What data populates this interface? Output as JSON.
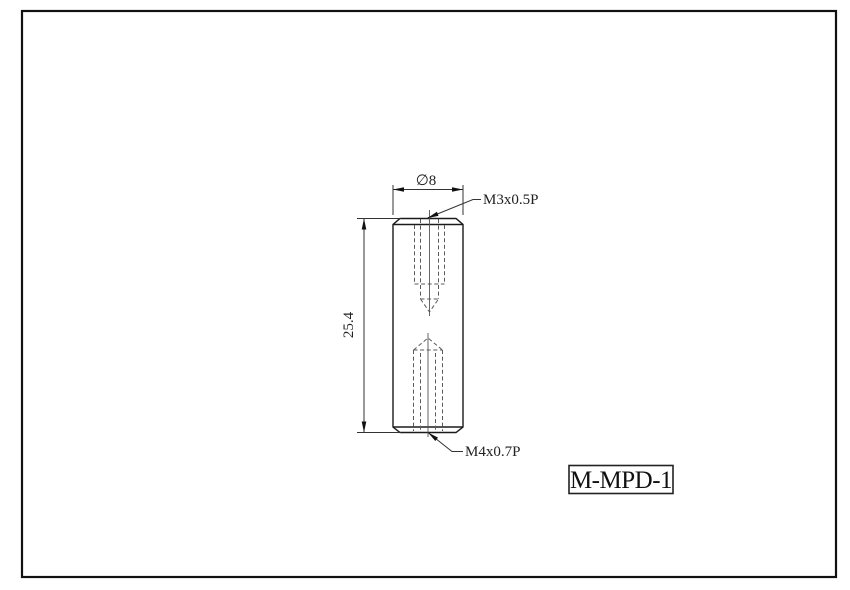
{
  "title_block": {
    "part_number": "M-MPD-1"
  },
  "dimensions": {
    "diameter": "∅8",
    "length": "25.4"
  },
  "thread_callouts": {
    "top": "M3x0.5P",
    "bottom": "M4x0.7P"
  },
  "colors": {
    "background": "#ffffff",
    "border": "#111111",
    "outline": "#1b1b1b",
    "hidden_line": "#5a5a5a",
    "dimension_line": "#333333",
    "text": "#222222"
  }
}
